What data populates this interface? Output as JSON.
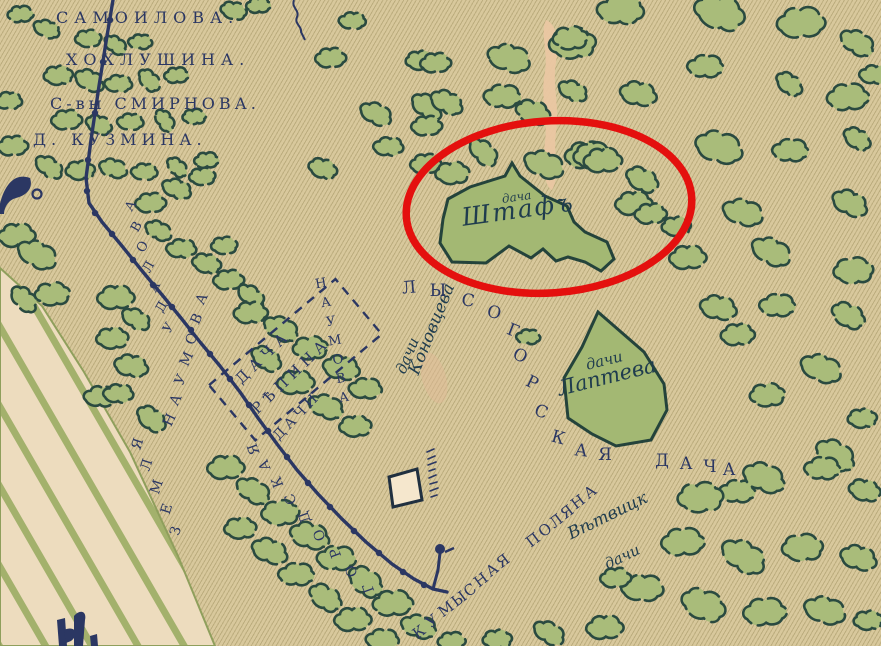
{
  "title": "Historic dacha map fragment (Kumysnaya Polyana area) with red ellipse highlighting the Shtaf dacha plot",
  "colors": {
    "paper": "#d8c89c",
    "ink_navy": "#2b3763",
    "tree_fill": "#a9bc7a",
    "tree_outline": "#2a4a40",
    "plot_fill": "#a3b873",
    "plot_outline": "#24433b",
    "stripe_cream": "#eddcbe",
    "stripe_green": "#a3b16c",
    "damage_patch": "#eac7a2",
    "highlight_red": "#e4100e"
  },
  "labels": {
    "samoilova": "САМОИЛОВА.",
    "khokhlushina": "ХОХЛУШИНА.",
    "smirnova": "С-вы СМИРНОВА.",
    "kuzmina": "Д. КУЗМИНА.",
    "dacha_repina_1": "ДАЧА",
    "dacha_repina_2": "РѢПИНА",
    "dachi_naumova": "ДАЧИ",
    "shtaf_small": "дача",
    "shtaf": "Штафъ",
    "laptev_small": "дачи",
    "laptev": "Лаптева",
    "konovtseva_small": "дачи",
    "konovtseva": "Коновцева",
    "vetvitsk_1": "Вѣтвицк",
    "vetvitsk_2": "дачи"
  },
  "annotations": {
    "red_ellipse": {
      "cx": 549,
      "cy": 207,
      "rx": 143,
      "ry": 86,
      "rot": -4,
      "stroke": "#e4100e",
      "width": 7.5
    }
  },
  "arc_words": [
    {
      "name": "lysogorskaya-dacha",
      "word": "ЛЫСОГОРСКАЯ ДАЧА",
      "font": 17,
      "rot": 0,
      "letters": [
        {
          "c": "Л",
          "x": 409,
          "y": 288,
          "r": -5
        },
        {
          "c": "Ы",
          "x": 438,
          "y": 291,
          "r": 0
        },
        {
          "c": "С",
          "x": 468,
          "y": 301,
          "r": 8
        },
        {
          "c": "О",
          "x": 494,
          "y": 313,
          "r": 15
        },
        {
          "c": "Г",
          "x": 513,
          "y": 331,
          "r": 22
        },
        {
          "c": "О",
          "x": 520,
          "y": 356,
          "r": 26
        },
        {
          "c": "Р",
          "x": 532,
          "y": 383,
          "r": 26
        },
        {
          "c": "С",
          "x": 541,
          "y": 412,
          "r": 22
        },
        {
          "c": "К",
          "x": 558,
          "y": 438,
          "r": 15
        },
        {
          "c": "А",
          "x": 581,
          "y": 451,
          "r": 6
        },
        {
          "c": "Я",
          "x": 605,
          "y": 455,
          "r": 0
        },
        {
          "c": "Д",
          "x": 662,
          "y": 461,
          "r": 0
        },
        {
          "c": "А",
          "x": 686,
          "y": 464,
          "r": 0
        },
        {
          "c": "Ч",
          "x": 710,
          "y": 467,
          "r": 0
        },
        {
          "c": "А",
          "x": 729,
          "y": 470,
          "r": 0
        }
      ]
    },
    {
      "name": "kumysnaya-polyana",
      "word": "КУМЫСНАЯ ПОЛЯНА",
      "font": 15,
      "rot": -37,
      "letters": [
        {
          "c": "К",
          "x": 419,
          "y": 632
        },
        {
          "c": "У",
          "x": 432,
          "y": 621
        },
        {
          "c": "М",
          "x": 446,
          "y": 609
        },
        {
          "c": "Ы",
          "x": 459,
          "y": 599
        },
        {
          "c": "С",
          "x": 470,
          "y": 590
        },
        {
          "c": "Н",
          "x": 481,
          "y": 580
        },
        {
          "c": "А",
          "x": 492,
          "y": 570
        },
        {
          "c": "Я",
          "x": 503,
          "y": 561
        },
        {
          "c": "П",
          "x": 533,
          "y": 540
        },
        {
          "c": "О",
          "x": 545,
          "y": 530
        },
        {
          "c": "Л",
          "x": 556,
          "y": 521
        },
        {
          "c": "Я",
          "x": 567,
          "y": 512
        },
        {
          "c": "Н",
          "x": 578,
          "y": 502
        },
        {
          "c": "А",
          "x": 590,
          "y": 492
        }
      ]
    },
    {
      "name": "gorodskaya",
      "word": "ГОРОДСКАЯ",
      "font": 14,
      "rot": -110,
      "letters": [
        {
          "c": "Г",
          "x": 369,
          "y": 588
        },
        {
          "c": "О",
          "x": 352,
          "y": 571
        },
        {
          "c": "Р",
          "x": 336,
          "y": 553
        },
        {
          "c": "О",
          "x": 320,
          "y": 535
        },
        {
          "c": "Д",
          "x": 305,
          "y": 517
        },
        {
          "c": "С",
          "x": 291,
          "y": 499
        },
        {
          "c": "К",
          "x": 278,
          "y": 482
        },
        {
          "c": "А",
          "x": 265,
          "y": 465
        },
        {
          "c": "Я",
          "x": 254,
          "y": 449
        }
      ]
    },
    {
      "name": "zemlya",
      "word": "ЗЕМЛЯ",
      "font": 14,
      "rot": -72,
      "letters": [
        {
          "c": "З",
          "x": 176,
          "y": 531
        },
        {
          "c": "Е",
          "x": 167,
          "y": 509
        },
        {
          "c": "М",
          "x": 157,
          "y": 487
        },
        {
          "c": "Л",
          "x": 147,
          "y": 465
        },
        {
          "c": "Я",
          "x": 138,
          "y": 444
        }
      ]
    },
    {
      "name": "udalova",
      "word": "УДАЛОВА",
      "font": 13,
      "rot": -60,
      "letters": [
        {
          "c": "А",
          "x": 131,
          "y": 206
        },
        {
          "c": "В",
          "x": 137,
          "y": 227
        },
        {
          "c": "О",
          "x": 143,
          "y": 247
        },
        {
          "c": "Л",
          "x": 149,
          "y": 267
        },
        {
          "c": "А",
          "x": 155,
          "y": 287
        },
        {
          "c": "Д",
          "x": 162,
          "y": 307
        },
        {
          "c": "У",
          "x": 169,
          "y": 328
        }
      ]
    },
    {
      "name": "naumova-west",
      "word": "НАУМОВА",
      "font": 14,
      "rot": -65,
      "letters": [
        {
          "c": "Н",
          "x": 170,
          "y": 420
        },
        {
          "c": "А",
          "x": 176,
          "y": 400
        },
        {
          "c": "У",
          "x": 181,
          "y": 380
        },
        {
          "c": "М",
          "x": 187,
          "y": 359
        },
        {
          "c": "О",
          "x": 192,
          "y": 339
        },
        {
          "c": "В",
          "x": 197,
          "y": 319
        },
        {
          "c": "А",
          "x": 202,
          "y": 299
        }
      ]
    },
    {
      "name": "naumova-east",
      "word": "НАУМОВА",
      "font": 13,
      "rot": -10,
      "letters": [
        {
          "c": "Н",
          "x": 321,
          "y": 284
        },
        {
          "c": "А",
          "x": 326,
          "y": 303
        },
        {
          "c": "У",
          "x": 331,
          "y": 322
        },
        {
          "c": "М",
          "x": 335,
          "y": 341
        },
        {
          "c": "О",
          "x": 338,
          "y": 360
        },
        {
          "c": "В",
          "x": 341,
          "y": 379
        },
        {
          "c": "А",
          "x": 344,
          "y": 398
        }
      ]
    }
  ],
  "trees": [
    [
      20,
      16,
      0.42,
      0,
      0
    ],
    [
      46,
      30,
      0.45,
      1,
      20
    ],
    [
      88,
      40,
      0.45,
      2,
      0
    ],
    [
      114,
      46,
      0.4,
      0,
      40
    ],
    [
      140,
      43,
      0.4,
      1,
      0
    ],
    [
      233,
      12,
      0.45,
      2,
      15
    ],
    [
      258,
      7,
      0.4,
      0,
      0
    ],
    [
      58,
      77,
      0.5,
      2,
      0
    ],
    [
      88,
      82,
      0.5,
      0,
      30
    ],
    [
      118,
      85,
      0.46,
      1,
      0
    ],
    [
      148,
      81,
      0.44,
      2,
      50
    ],
    [
      176,
      77,
      0.4,
      0,
      0
    ],
    [
      8,
      102,
      0.46,
      1,
      0
    ],
    [
      66,
      122,
      0.5,
      0,
      0
    ],
    [
      98,
      126,
      0.46,
      2,
      25
    ],
    [
      130,
      123,
      0.44,
      1,
      0
    ],
    [
      163,
      121,
      0.4,
      0,
      60
    ],
    [
      194,
      118,
      0.4,
      2,
      0
    ],
    [
      12,
      148,
      0.5,
      0,
      0
    ],
    [
      48,
      168,
      0.5,
      1,
      35
    ],
    [
      80,
      172,
      0.5,
      2,
      0
    ],
    [
      112,
      170,
      0.46,
      0,
      20
    ],
    [
      144,
      173,
      0.44,
      1,
      0
    ],
    [
      176,
      168,
      0.4,
      2,
      45
    ],
    [
      206,
      162,
      0.4,
      0,
      0
    ],
    [
      16,
      238,
      0.6,
      0,
      0
    ],
    [
      36,
      256,
      0.68,
      1,
      25
    ],
    [
      52,
      296,
      0.6,
      2,
      0
    ],
    [
      22,
      300,
      0.5,
      0,
      50
    ],
    [
      100,
      398,
      0.55,
      1,
      0
    ],
    [
      115,
      300,
      0.6,
      0,
      0
    ],
    [
      135,
      320,
      0.5,
      1,
      30
    ],
    [
      112,
      340,
      0.55,
      2,
      0
    ],
    [
      130,
      368,
      0.55,
      0,
      15
    ],
    [
      118,
      395,
      0.5,
      1,
      0
    ],
    [
      150,
      420,
      0.55,
      2,
      40
    ],
    [
      150,
      205,
      0.5,
      0,
      0
    ],
    [
      176,
      190,
      0.5,
      1,
      20
    ],
    [
      202,
      178,
      0.45,
      2,
      0
    ],
    [
      157,
      232,
      0.45,
      0,
      30
    ],
    [
      181,
      250,
      0.5,
      1,
      0
    ],
    [
      206,
      265,
      0.5,
      2,
      15
    ],
    [
      228,
      282,
      0.5,
      0,
      0
    ],
    [
      250,
      297,
      0.5,
      1,
      40
    ],
    [
      224,
      247,
      0.45,
      2,
      0
    ],
    [
      250,
      315,
      0.55,
      0,
      0
    ],
    [
      280,
      330,
      0.6,
      1,
      25
    ],
    [
      310,
      350,
      0.6,
      2,
      0
    ],
    [
      340,
      370,
      0.6,
      0,
      15
    ],
    [
      365,
      390,
      0.55,
      1,
      0
    ],
    [
      265,
      360,
      0.55,
      2,
      35
    ],
    [
      295,
      385,
      0.6,
      0,
      0
    ],
    [
      325,
      408,
      0.6,
      1,
      20
    ],
    [
      355,
      428,
      0.55,
      2,
      0
    ],
    [
      225,
      470,
      0.6,
      0,
      0
    ],
    [
      252,
      492,
      0.6,
      1,
      30
    ],
    [
      280,
      515,
      0.65,
      2,
      0
    ],
    [
      308,
      538,
      0.65,
      0,
      20
    ],
    [
      336,
      560,
      0.65,
      1,
      0
    ],
    [
      364,
      583,
      0.65,
      2,
      40
    ],
    [
      392,
      606,
      0.65,
      0,
      0
    ],
    [
      418,
      628,
      0.6,
      1,
      15
    ],
    [
      240,
      530,
      0.55,
      2,
      0
    ],
    [
      268,
      553,
      0.6,
      0,
      25
    ],
    [
      296,
      576,
      0.6,
      1,
      0
    ],
    [
      324,
      599,
      0.6,
      2,
      35
    ],
    [
      352,
      622,
      0.6,
      0,
      0
    ],
    [
      382,
      641,
      0.55,
      1,
      0
    ],
    [
      330,
      60,
      0.5,
      0,
      0
    ],
    [
      375,
      115,
      0.55,
      1,
      25
    ],
    [
      420,
      62,
      0.5,
      2,
      0
    ],
    [
      425,
      108,
      0.55,
      0,
      40
    ],
    [
      388,
      148,
      0.5,
      1,
      0
    ],
    [
      322,
      170,
      0.5,
      2,
      20
    ],
    [
      425,
      166,
      0.5,
      0,
      0
    ],
    [
      352,
      22,
      0.45,
      1,
      0
    ],
    [
      435,
      65,
      0.5,
      0,
      0
    ],
    [
      508,
      60,
      0.72,
      1,
      15
    ],
    [
      572,
      46,
      0.8,
      2,
      0
    ],
    [
      445,
      104,
      0.55,
      0,
      30
    ],
    [
      502,
      98,
      0.62,
      1,
      0
    ],
    [
      532,
      114,
      0.6,
      2,
      20
    ],
    [
      426,
      128,
      0.5,
      0,
      0
    ],
    [
      482,
      153,
      0.55,
      1,
      45
    ],
    [
      585,
      158,
      0.68,
      0,
      0
    ],
    [
      620,
      12,
      0.78,
      1,
      0
    ],
    [
      718,
      15,
      0.88,
      2,
      20
    ],
    [
      800,
      26,
      0.78,
      0,
      0
    ],
    [
      856,
      44,
      0.6,
      1,
      30
    ],
    [
      570,
      40,
      0.6,
      2,
      0
    ],
    [
      637,
      96,
      0.6,
      0,
      15
    ],
    [
      705,
      68,
      0.6,
      1,
      0
    ],
    [
      788,
      85,
      0.5,
      2,
      40
    ],
    [
      847,
      100,
      0.68,
      0,
      0
    ],
    [
      572,
      92,
      0.5,
      1,
      25
    ],
    [
      593,
      158,
      0.68,
      2,
      0
    ],
    [
      717,
      150,
      0.78,
      0,
      20
    ],
    [
      790,
      152,
      0.6,
      1,
      0
    ],
    [
      856,
      140,
      0.5,
      2,
      35
    ],
    [
      633,
      206,
      0.6,
      0,
      0
    ],
    [
      742,
      214,
      0.68,
      1,
      15
    ],
    [
      676,
      228,
      0.5,
      2,
      0
    ],
    [
      848,
      205,
      0.6,
      0,
      30
    ],
    [
      874,
      76,
      0.5,
      1,
      0
    ],
    [
      452,
      175,
      0.58,
      2,
      0
    ],
    [
      543,
      166,
      0.68,
      1,
      20
    ],
    [
      602,
      163,
      0.62,
      0,
      0
    ],
    [
      641,
      181,
      0.58,
      2,
      30
    ],
    [
      650,
      216,
      0.52,
      0,
      0
    ],
    [
      687,
      260,
      0.6,
      0,
      0
    ],
    [
      770,
      253,
      0.68,
      1,
      25
    ],
    [
      853,
      273,
      0.68,
      2,
      0
    ],
    [
      717,
      310,
      0.6,
      0,
      15
    ],
    [
      777,
      307,
      0.6,
      1,
      0
    ],
    [
      847,
      317,
      0.6,
      2,
      30
    ],
    [
      737,
      337,
      0.55,
      0,
      0
    ],
    [
      820,
      370,
      0.7,
      1,
      20
    ],
    [
      767,
      397,
      0.6,
      2,
      0
    ],
    [
      833,
      457,
      0.68,
      0,
      35
    ],
    [
      737,
      493,
      0.6,
      1,
      0
    ],
    [
      862,
      420,
      0.5,
      2,
      0
    ],
    [
      528,
      338,
      0.4,
      1,
      0
    ],
    [
      700,
      500,
      0.78,
      2,
      0
    ],
    [
      762,
      480,
      0.7,
      0,
      25
    ],
    [
      822,
      470,
      0.6,
      1,
      0
    ],
    [
      864,
      492,
      0.55,
      2,
      15
    ],
    [
      682,
      545,
      0.7,
      0,
      0
    ],
    [
      742,
      558,
      0.78,
      1,
      30
    ],
    [
      802,
      550,
      0.7,
      2,
      0
    ],
    [
      857,
      560,
      0.6,
      0,
      20
    ],
    [
      642,
      590,
      0.7,
      1,
      0
    ],
    [
      702,
      607,
      0.78,
      2,
      25
    ],
    [
      764,
      615,
      0.7,
      0,
      0
    ],
    [
      824,
      612,
      0.7,
      1,
      15
    ],
    [
      868,
      622,
      0.5,
      2,
      0
    ],
    [
      604,
      630,
      0.6,
      0,
      0
    ],
    [
      548,
      634,
      0.55,
      1,
      30
    ],
    [
      497,
      641,
      0.5,
      2,
      0
    ],
    [
      451,
      643,
      0.45,
      0,
      0
    ],
    [
      615,
      580,
      0.5,
      0,
      0
    ]
  ]
}
